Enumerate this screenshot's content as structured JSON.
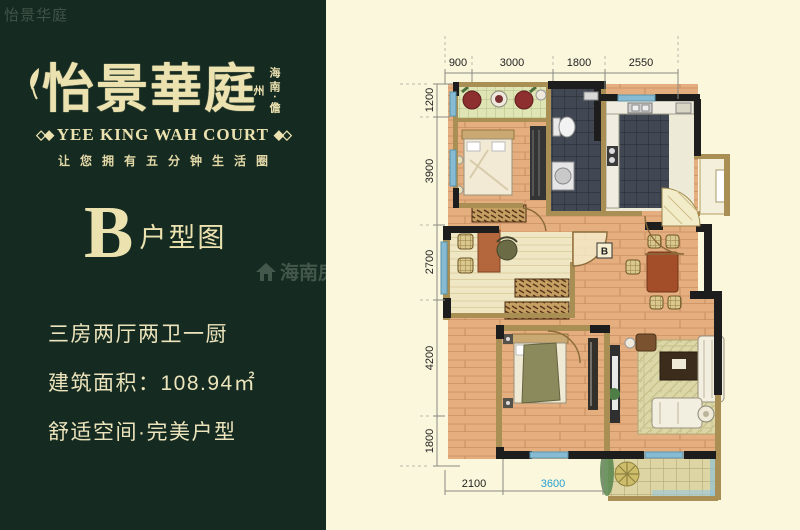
{
  "colors": {
    "panel_green": "#152a20",
    "paper_cream": "#fbf7dc",
    "brand_gold": "#ece2b0",
    "wall_black": "#1d1d1d",
    "wall_tan": "#aa8f55",
    "window_blue": "#86bbd3",
    "dim_highlight_blue": "#2a9fd0"
  },
  "corner_watermark": "怡景华庭",
  "left_panel": {
    "logo_cn": "怡景華庭",
    "logo_region_vertical": "海南·儋州",
    "logo_en": "YEE KING WAH COURT",
    "ornament_left": "◇◆",
    "ornament_right": "◆◇",
    "slogan": "让您拥有五分钟生活圈",
    "type_letter": "B",
    "type_label": "户型图",
    "specs": [
      "三房两厅两卫一厨",
      "建筑面积：108.94㎡",
      "舒适空间·完美户型"
    ]
  },
  "watermark": {
    "site_cn": "海南房",
    "site_en": "akee.com"
  },
  "plan": {
    "room_marker": "B",
    "dims_top": [
      "900",
      "3000",
      "1800",
      "2550"
    ],
    "dims_left": [
      "1200",
      "3900",
      "2700",
      "4200",
      "1800"
    ],
    "dims_bottom": [
      "2100",
      "3600"
    ]
  }
}
